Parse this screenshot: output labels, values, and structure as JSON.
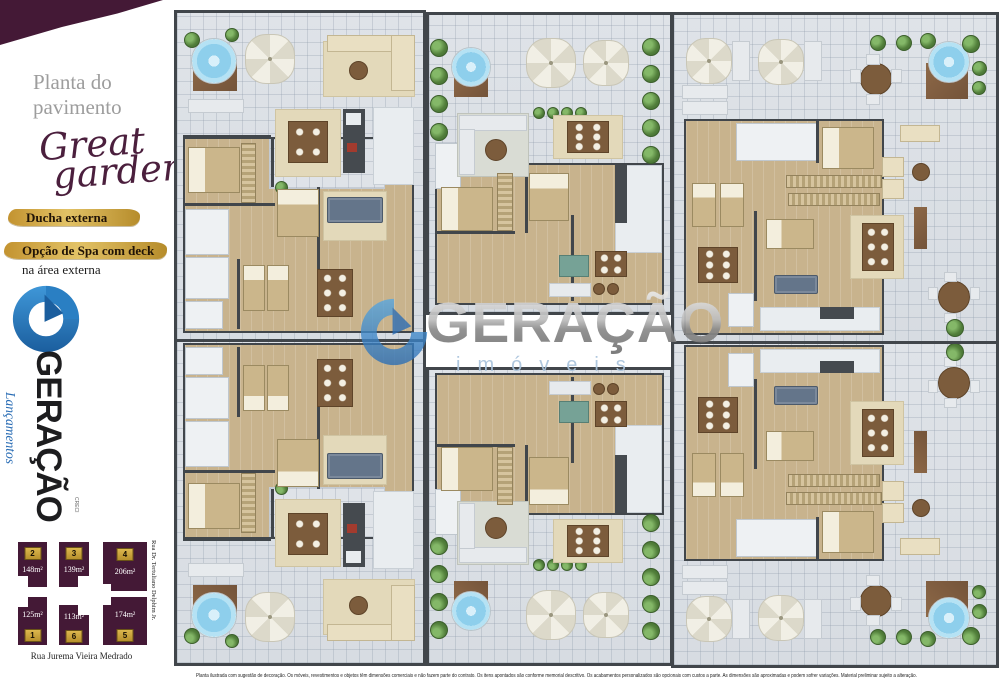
{
  "sidebar": {
    "title": "Planta do pavimento",
    "brand": {
      "line1": "Great",
      "line2": "garden"
    },
    "features": {
      "f1": "Ducha externa",
      "f2a": "Opção de Spa com deck",
      "f2b": "na área externa"
    },
    "logo": {
      "name": "GERAÇÃO",
      "tagline": "Lançamentos",
      "creci": "CRECI"
    }
  },
  "keymap": {
    "street_bottom": "Rua Jurema Vieira Medrado",
    "street_right": "Rua Dr. Tertuliano Delphim Jr.",
    "units": [
      {
        "number": "2",
        "area": "148m²"
      },
      {
        "number": "3",
        "area": "139m²"
      },
      {
        "number": "4",
        "area": "206m²"
      },
      {
        "number": "1",
        "area": "125m²"
      },
      {
        "number": "6",
        "area": "113m²"
      },
      {
        "number": "5",
        "area": "174m²"
      }
    ]
  },
  "watermark": {
    "brand": "GERAÇÃO",
    "sub": "imóveis"
  },
  "footer": {
    "disclaimer": "Planta ilustrada com sugestão de decoração. Os móveis, revestimentos e objetos têm dimensões comerciais e não fazem parte do contrato. Os itens apontados são conforme memorial descritivo. Os acabamentos personalizados são opcionais com custos a parte. As dimensões são aproximadas e podem sofrer variações. Material preliminar sujeito a alteração."
  },
  "colors": {
    "plum": "#441936",
    "gold": "#c49a3c",
    "logo_blue": "#2a7fc3",
    "wood": "#c8b38d",
    "tile": "#dfe3e8"
  }
}
